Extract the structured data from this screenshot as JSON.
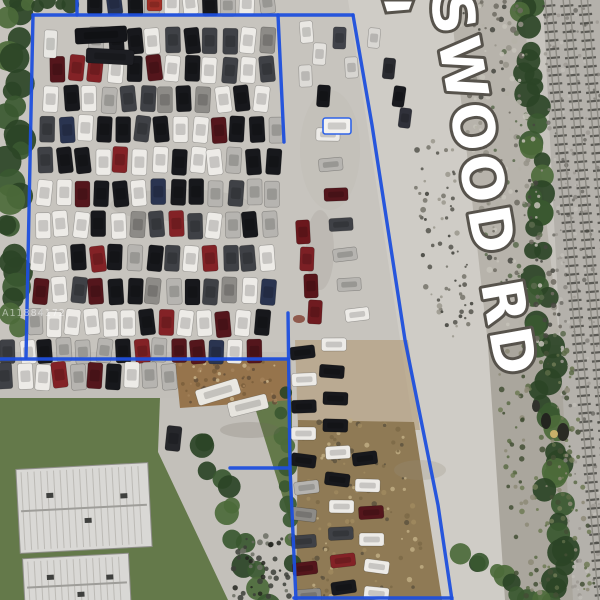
{
  "overlay": {
    "road_label": {
      "text": "SWOOD RD",
      "fill": "#ffffff",
      "outline": "#57534c"
    },
    "watermark": {
      "text": "A11884172"
    },
    "boundary_color": "#1d4fdd"
  },
  "scene": {
    "description": "aerial-view-auto-salvage-yard-with-parcel-outline",
    "palette": {
      "pavement": "#c7c4be",
      "road": "#cfccc6",
      "grass": "#64794a",
      "gravel": "#b4b1ab",
      "tree": [
        "#2b4426",
        "#3a5830",
        "#4c6a3a"
      ],
      "boundary": "#1d4fdd"
    },
    "boundary_polylines": [
      [
        [
          77,
          0
        ],
        [
          77,
          15
        ]
      ],
      [
        [
          33,
          15
        ],
        [
          353,
          15
        ]
      ],
      [
        [
          33,
          15
        ],
        [
          26,
          358
        ]
      ],
      [
        [
          0,
          359
        ],
        [
          288,
          359
        ]
      ],
      [
        [
          353,
          15
        ],
        [
          372,
          125
        ],
        [
          405,
          340
        ],
        [
          438,
          505
        ],
        [
          452,
          600
        ]
      ],
      [
        [
          278,
          15
        ],
        [
          284,
          142
        ]
      ],
      [
        [
          288,
          313
        ],
        [
          290,
          468
        ],
        [
          296,
          600
        ]
      ],
      [
        [
          230,
          468
        ],
        [
          290,
          468
        ]
      ],
      [
        [
          294,
          598
        ],
        [
          452,
          598
        ]
      ]
    ],
    "car_palette": [
      [
        "#edebe7",
        32
      ],
      [
        "#17181c",
        22
      ],
      [
        "#3f4146",
        12
      ],
      [
        "#b6b4b0",
        14
      ],
      [
        "#8d8b87",
        6
      ],
      [
        "#832226",
        7
      ],
      [
        "#54161c",
        4
      ],
      [
        "#2a3450",
        3
      ]
    ],
    "car_rows": [
      {
        "y": -7,
        "x0": 96,
        "x1": 268,
        "pitch": 19,
        "w": 15,
        "h": 22
      },
      {
        "y": 27,
        "x0": 96,
        "x1": 274,
        "pitch": 19,
        "w": 15,
        "h": 26
      },
      {
        "y": 56,
        "x0": 58,
        "x1": 274,
        "pitch": 19,
        "w": 15,
        "h": 26
      },
      {
        "y": 86,
        "x0": 52,
        "x1": 276,
        "pitch": 19,
        "w": 15,
        "h": 26
      },
      {
        "y": 116,
        "x0": 48,
        "x1": 276,
        "pitch": 19,
        "w": 15,
        "h": 26
      },
      {
        "y": 148,
        "x0": 45,
        "x1": 278,
        "pitch": 19,
        "w": 15,
        "h": 26
      },
      {
        "y": 180,
        "x0": 45,
        "x1": 278,
        "pitch": 19,
        "w": 15,
        "h": 26
      },
      {
        "y": 212,
        "x0": 42,
        "x1": 278,
        "pitch": 19,
        "w": 15,
        "h": 26
      },
      {
        "y": 245,
        "x0": 40,
        "x1": 278,
        "pitch": 19,
        "w": 15,
        "h": 26
      },
      {
        "y": 278,
        "x0": 40,
        "x1": 278,
        "pitch": 19,
        "w": 15,
        "h": 26
      },
      {
        "y": 310,
        "x0": 34,
        "x1": 272,
        "pitch": 19,
        "w": 15,
        "h": 26
      },
      {
        "y": 339,
        "x0": 8,
        "x1": 262,
        "pitch": 19,
        "w": 15,
        "h": 24
      },
      {
        "y": 363,
        "x0": 6,
        "x1": 180,
        "pitch": 18,
        "w": 15,
        "h": 26
      }
    ],
    "car_columns": [
      {
        "x": 302,
        "y0": 346,
        "y1": 592,
        "pitch": 27,
        "w": 25,
        "h": 13,
        "drift": 0.02
      },
      {
        "x": 332,
        "y0": 338,
        "y1": 592,
        "pitch": 27,
        "w": 25,
        "h": 13,
        "drift": 0.05
      },
      {
        "x": 365,
        "y0": 452,
        "y1": 592,
        "pitch": 27,
        "w": 25,
        "h": 13,
        "drift": 0.09
      },
      {
        "x": 327,
        "y0": 128,
        "y1": 332,
        "pitch": 30,
        "w": 24,
        "h": 13,
        "drift": 0.16
      }
    ],
    "car_singles": [
      [
        75,
        27,
        52,
        16,
        -3,
        "#141519"
      ],
      [
        86,
        49,
        48,
        15,
        3,
        "#1d1e23"
      ],
      [
        44,
        30,
        13,
        28,
        2,
        "#e8e7e3"
      ],
      [
        196,
        384,
        44,
        16,
        -17,
        "#eae8e2"
      ],
      [
        228,
        398,
        40,
        15,
        -14,
        "#e6e4de"
      ],
      [
        166,
        426,
        15,
        25,
        6,
        "#26272b"
      ],
      [
        323,
        118,
        28,
        16,
        0,
        "#f3f2ef",
        "#2e63e8"
      ],
      [
        300,
        21,
        13,
        22,
        -4,
        "#e9e7e3"
      ],
      [
        313,
        43,
        13,
        22,
        3,
        "#e4e2de"
      ],
      [
        299,
        65,
        13,
        22,
        -2,
        "#dddbd7"
      ],
      [
        317,
        85,
        13,
        22,
        4,
        "#16171b"
      ],
      [
        333,
        27,
        13,
        22,
        2,
        "#41434a"
      ],
      [
        345,
        57,
        13,
        21,
        -3,
        "#d7d5d1"
      ],
      [
        368,
        28,
        12,
        20,
        5,
        "#d9d7d3"
      ],
      [
        383,
        58,
        12,
        21,
        6,
        "#2a2b30"
      ],
      [
        393,
        86,
        12,
        21,
        8,
        "#191a1e"
      ],
      [
        399,
        108,
        12,
        20,
        7,
        "#30313a"
      ],
      [
        296,
        220,
        14,
        24,
        -3,
        "#6b181d"
      ],
      [
        300,
        247,
        14,
        24,
        2,
        "#7c2025"
      ],
      [
        304,
        274,
        14,
        24,
        -2,
        "#58151a"
      ],
      [
        308,
        300,
        14,
        24,
        3,
        "#6f1b20"
      ],
      [
        147,
        -2,
        15,
        13,
        0,
        "#a03028"
      ]
    ],
    "tree_strips": [
      {
        "x1": 16,
        "y1": -4,
        "x2": 13,
        "y2": 326,
        "n": 26,
        "r1": 9,
        "r2": 16,
        "spread": 9
      },
      {
        "x1": 14,
        "y1": 2,
        "x2": 70,
        "y2": 5,
        "n": 6,
        "r1": 5,
        "r2": 9,
        "spread": 4
      },
      {
        "x1": 524,
        "y1": -4,
        "x2": 560,
        "y2": 604,
        "n": 52,
        "r1": 8,
        "r2": 14,
        "spread": 10
      },
      {
        "x1": 200,
        "y1": 436,
        "x2": 266,
        "y2": 600,
        "n": 13,
        "r1": 8,
        "r2": 13,
        "spread": 8
      },
      {
        "x1": 282,
        "y1": 396,
        "x2": 288,
        "y2": 560,
        "n": 10,
        "r1": 6,
        "r2": 10,
        "spread": 5
      },
      {
        "x1": 462,
        "y1": 556,
        "x2": 540,
        "y2": 600,
        "n": 9,
        "r1": 7,
        "r2": 11,
        "spread": 6
      }
    ],
    "speckle_regions": [
      {
        "x": 450,
        "y": 0,
        "w": 70,
        "h": 345,
        "skew": 0.13,
        "n": 240,
        "rmin": 1,
        "rmax": 3.2,
        "colors": [
          "#979388",
          "#6e6b62",
          "#b5b1a7",
          "#c6c2b8",
          "#5a6a4c",
          "#474740"
        ]
      },
      {
        "x": 408,
        "y": 140,
        "w": 44,
        "h": 200,
        "skew": 0.12,
        "n": 70,
        "rmin": 1,
        "rmax": 3,
        "colors": [
          "#76736a",
          "#55534c",
          "#9a968c",
          "#3d3d37"
        ]
      },
      {
        "x": 542,
        "y": 0,
        "w": 58,
        "h": 600,
        "skew": 0.05,
        "n": 240,
        "rmin": 0.8,
        "rmax": 2.4,
        "colors": [
          "#9d9a93",
          "#86847d",
          "#c0bdb6",
          "#6f6d66"
        ]
      },
      {
        "x": 298,
        "y": 420,
        "w": 112,
        "h": 178,
        "skew": 0.09,
        "n": 130,
        "rmin": 1,
        "rmax": 2.8,
        "colors": [
          "#7c6a48",
          "#a08a5f",
          "#5e5340",
          "#c0ad84"
        ]
      },
      {
        "x": 178,
        "y": 358,
        "w": 104,
        "h": 46,
        "skew": 0,
        "n": 60,
        "rmin": 1,
        "rmax": 2.6,
        "colors": [
          "#7b5f3c",
          "#a5835a",
          "#64503a",
          "#c9b48b"
        ]
      },
      {
        "x": 492,
        "y": 345,
        "w": 80,
        "h": 255,
        "skew": 0.1,
        "n": 150,
        "rmin": 1,
        "rmax": 3,
        "colors": [
          "#5c6b47",
          "#434f35",
          "#8d8a77",
          "#6f7a55"
        ]
      },
      {
        "x": 232,
        "y": 536,
        "w": 62,
        "h": 62,
        "skew": 0,
        "n": 46,
        "rmin": 1.2,
        "rmax": 3,
        "colors": [
          "#3c3e38",
          "#23241f",
          "#6b6d63"
        ]
      }
    ],
    "tracks": [
      [
        548,
        -4,
        602,
        604
      ],
      [
        566,
        -4,
        620,
        604
      ],
      [
        584,
        -4,
        638,
        604
      ]
    ],
    "roofs": [
      {
        "x": 18,
        "y": 466,
        "w": 132,
        "h": 84,
        "rot": -3
      },
      {
        "x": 24,
        "y": 556,
        "w": 106,
        "h": 58,
        "rot": -3
      }
    ]
  }
}
